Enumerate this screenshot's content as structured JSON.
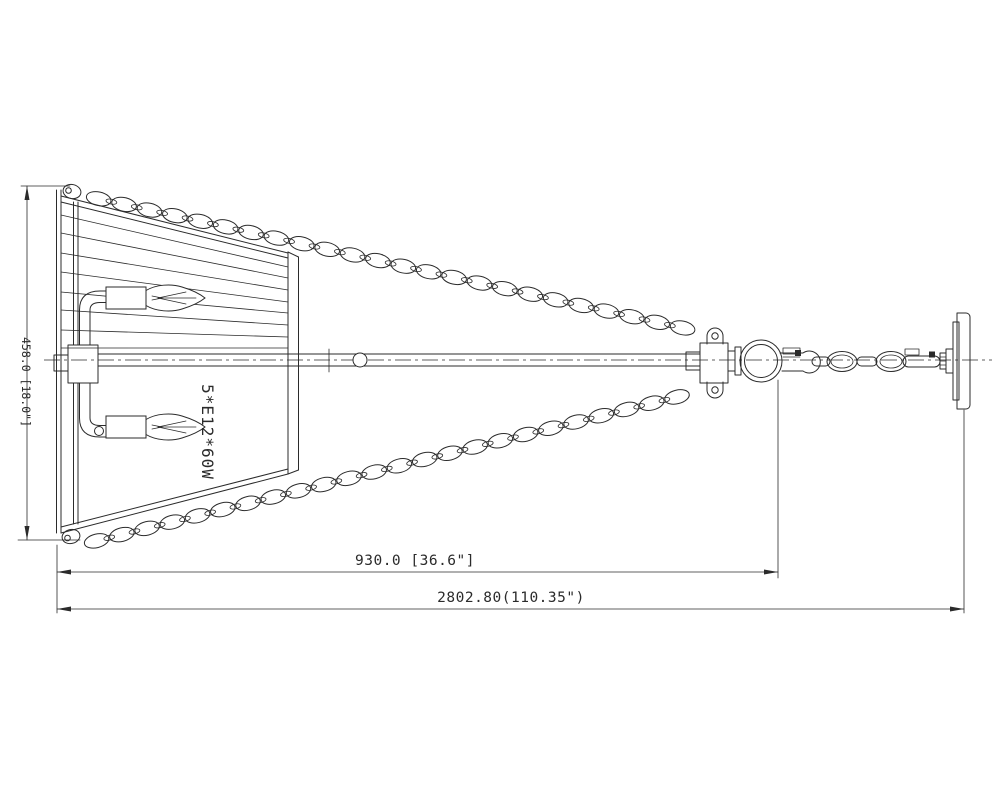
{
  "drawing": {
    "title_semantic": "pendant-light-technical-drawing",
    "bulb_label": "5*E12*60W",
    "dim_height": "458.0 [18.0\"]",
    "dim_inner": "930.0 [36.6\"]",
    "dim_overall": "2802.80(110.35\")",
    "line_color": "#2b2b2b",
    "background_color": "#ffffff"
  }
}
